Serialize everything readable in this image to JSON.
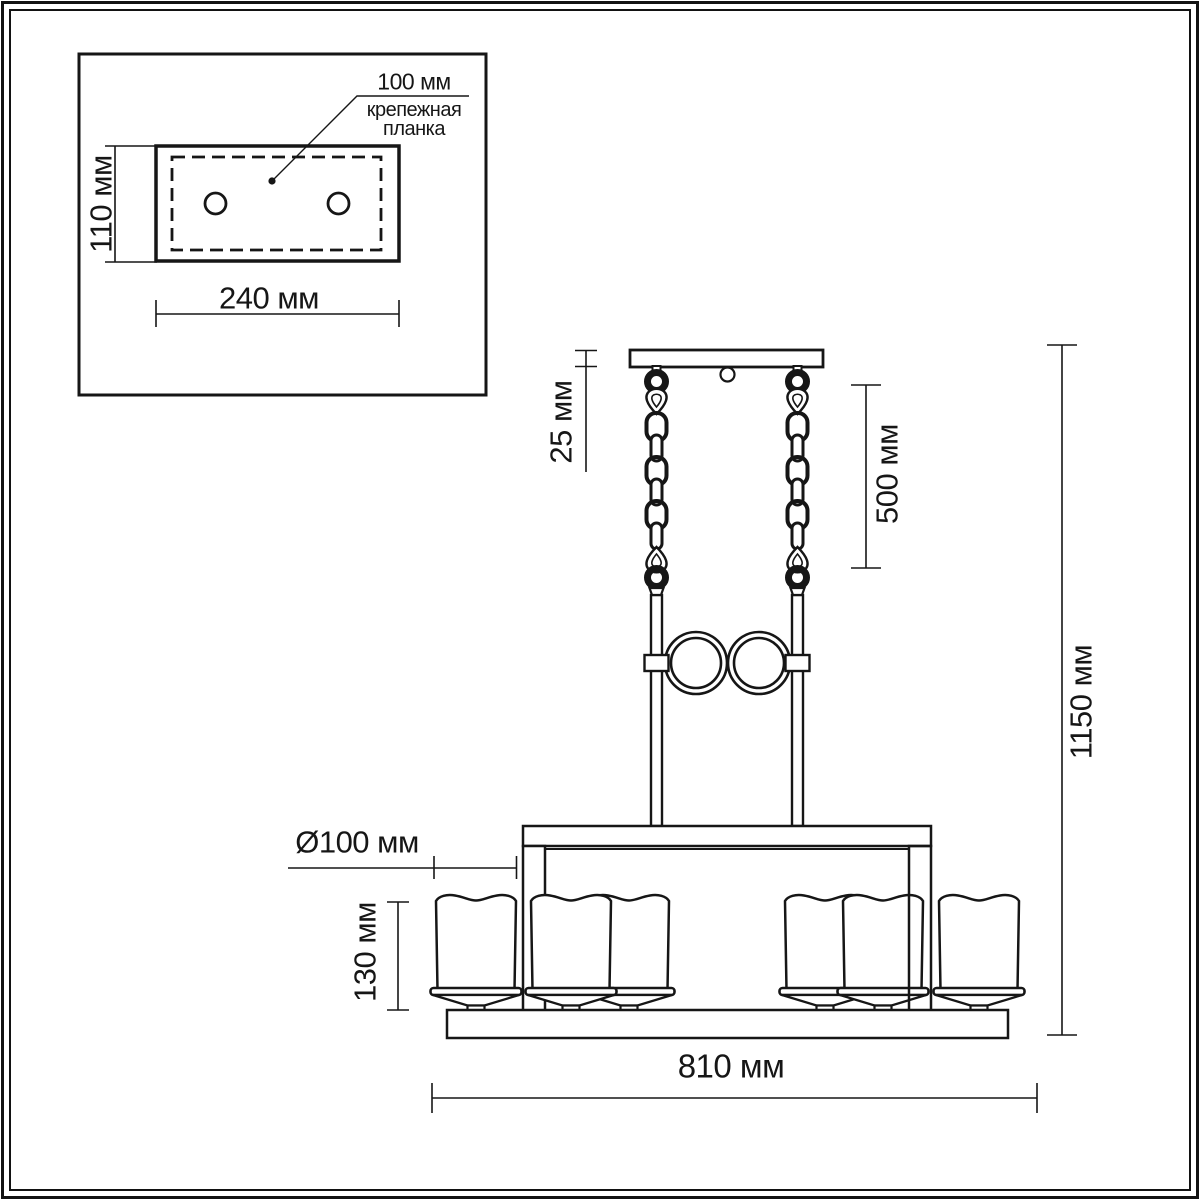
{
  "colors": {
    "background": "#ffffff",
    "line": "#161616"
  },
  "detail_inset": {
    "hole_spacing_label": "100 мм",
    "caption_line1": "крепежная",
    "caption_line2": "планка",
    "plate_height_label": "110 мм",
    "plate_width_label": "240 мм"
  },
  "main_drawing": {
    "canopy_height_label": "25 мм",
    "chain_length_label": "500 мм",
    "overall_height_label": "1150 мм",
    "shade_diameter_label": "Ø100 мм",
    "shade_height_label": "130 мм",
    "overall_width_label": "810 мм"
  }
}
